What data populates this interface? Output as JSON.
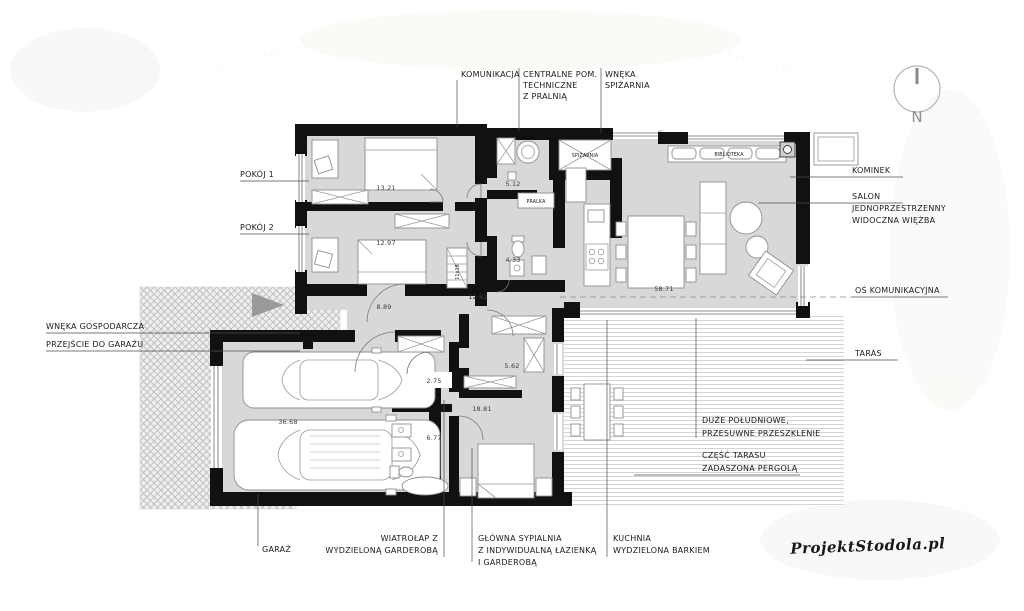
{
  "plan": {
    "callouts": {
      "komunikacja": "KOMUNIKACJA",
      "centralne_line1": "CENTRALNE POM.",
      "centralne_line2": "TECHNICZNE",
      "centralne_line3": "Z PRALNIĄ",
      "wneka_spizarnia_line1": "WNĘKA",
      "wneka_spizarnia_line2": "SPIŻARNIA",
      "pokoj1": "POKÓJ 1",
      "pokoj2": "POKÓJ 2",
      "wneka_gospodarcza": "WNĘKA GOSPODARCZA",
      "przejscie_do_garazu": "PRZEJŚCIE DO GARAŻU",
      "kominek": "KOMINEK",
      "salon_line1": "SALON",
      "salon_line2": "JEDNOPRZESTRZENNY",
      "salon_line3": "WIDOCZNA WIĘŹBA",
      "os_komunikacyjna": "OŚ KOMUNIKACYJNA",
      "taras": "TARAS",
      "garaz": "GARAŻ",
      "wiatrolap_line1": "WIATROŁAP Z",
      "wiatrolap_line2": "WYDZIELONĄ GARDEROBĄ",
      "sypialnia_line1": "GŁÓWNA SYPIALNIA",
      "sypialnia_line2": "Z INDYWIDUALNĄ ŁAZIENKĄ",
      "sypialnia_line3": "I GARDEROBĄ",
      "kuchnia_line1": "KUCHNIA",
      "kuchnia_line2": "WYDZIELONA BARKIEM",
      "przeszklenie_line1": "DUŻE POŁUDNIOWE,",
      "przeszklenie_line2": "PRZESUWNE PRZESZKLENIE",
      "pergola_line1": "CZĘŚĆ TARASU",
      "pergola_line2": "ZADASZONA PERGOLĄ"
    },
    "areas": {
      "pokoj1": "13.21",
      "pokoj2": "12.97",
      "pom_techniczne": "5.12",
      "lazienka": "4.33",
      "komunikacja": "12.62",
      "hol": "8.89",
      "salon": "58.71",
      "garaz": "36.68",
      "garderoba_wiatrolap": "2.75",
      "lazienka_glowna": "6.77",
      "garderoba_sypialni": "5.62",
      "sypialnia": "18.81"
    },
    "room_texts": {
      "spizarnia": "SPIŻARNIA",
      "pralka": "PRALKA",
      "biblioteka": "BIBLIOTEKA",
      "schody_strychowe": "11x18"
    },
    "compass": {
      "label": "N"
    },
    "watermark": "ProjektStodola.pl",
    "colors": {
      "wall": "#111111",
      "floor": "#d8d8d8",
      "deck_line": "#c9c9c9",
      "hatch_line": "#b9b9b9",
      "arrow": "#9a9a9a",
      "text": "#1a1a1a"
    }
  }
}
